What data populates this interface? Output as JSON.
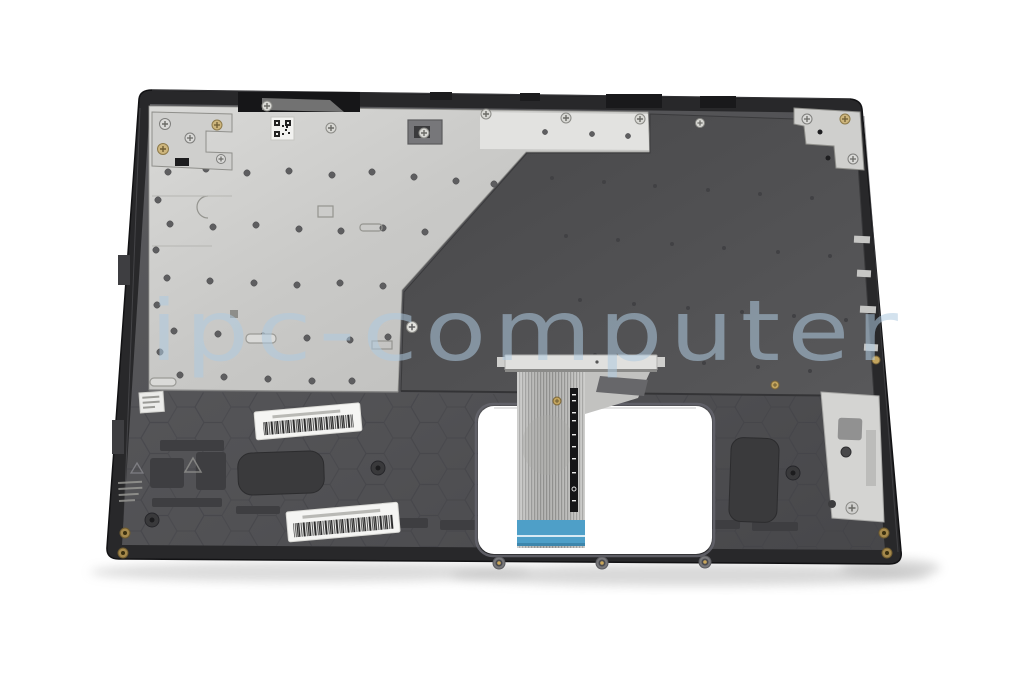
{
  "image": {
    "type": "product-photo",
    "subject": "Laptop top case palmrest with keyboard plate, underside view, with keyboard ribbon cable",
    "background": "#ffffff"
  },
  "watermark": {
    "text": "ipc-computer",
    "color": "#aecbe0"
  },
  "part": {
    "shell_color": "#28282a",
    "palmrest_color": "#525255",
    "plate_silver_color": "#cbcbc9",
    "plate_dark_color": "#4d4d4f",
    "ribbon_color": "#c6c6c4",
    "ribbon_tip_color": "#4e9fc8",
    "foam_pad_color": "#3a3a3c",
    "bracket_color": "#d4d4d2",
    "brass_color": "#a5894c"
  },
  "stickers": {
    "qr_label": {
      "kind": "qr-code",
      "text_legible": false
    },
    "barcode_label_upper": {
      "kind": "barcode",
      "text_legible": false
    },
    "barcode_label_lower": {
      "kind": "barcode",
      "text_legible": false
    },
    "mini_label": {
      "kind": "text-label",
      "text_legible": false
    }
  }
}
